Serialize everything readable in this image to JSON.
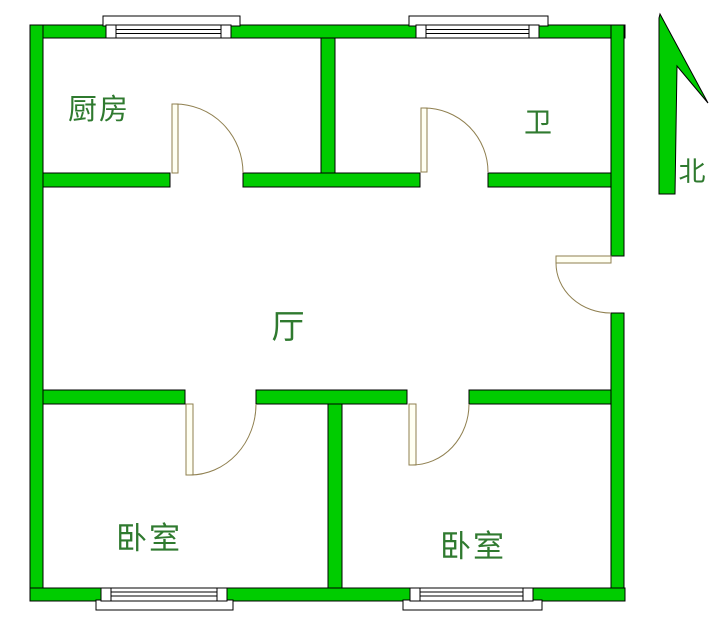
{
  "title": "apartment-floor-plan",
  "rooms": {
    "kitchen": {
      "label": "厨房"
    },
    "bathroom": {
      "label": "卫"
    },
    "hall": {
      "label": "厅"
    },
    "bedroom_left": {
      "label": "卧室"
    },
    "bedroom_right": {
      "label": "卧室"
    }
  },
  "compass": {
    "north_label": "北"
  },
  "colors": {
    "wall": "#00cc00",
    "outline": "#000000",
    "door_line": "#8f7f4f",
    "door_leaf_fill": "#fffff2",
    "label_text": "#2f7a2f",
    "background": "#ffffff"
  }
}
